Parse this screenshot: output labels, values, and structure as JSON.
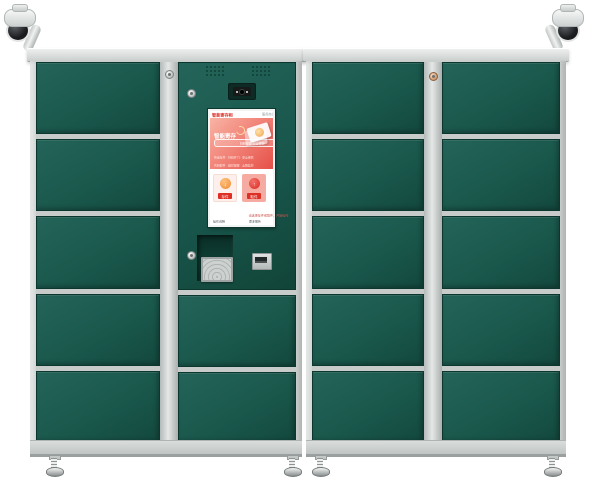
{
  "scene": {
    "background_color": "#ffffff",
    "cabinet_frame_color": "#ced3d2",
    "door_color": "#1a584c",
    "accent_red": "#e03a2e",
    "accent_orange": "#ee8c33"
  },
  "cabinets": {
    "left": {
      "left_column_door_count": 5,
      "control_column_door_count": 2
    },
    "right": {
      "left_column_door_count": 5,
      "right_column_door_count": 5
    }
  },
  "kiosk": {
    "screen": {
      "header": {
        "brand": "智能寄存柜",
        "meta": "服务热线"
      },
      "hero": {
        "title": "智能寄存",
        "badge": "扫码存取 安全便捷",
        "feature_line1": "快速存件 · 扫码开门 · 安全保管",
        "feature_line2": "凭码取件 · 超时提醒 · 全程监控"
      },
      "actions": [
        {
          "label": "存件",
          "glyph": "↓"
        },
        {
          "label": "取件",
          "glyph": "↑"
        }
      ],
      "caption": "请选择存件或取件，开始操作",
      "footer_left": "操作说明",
      "footer_right": "更多服务"
    }
  }
}
